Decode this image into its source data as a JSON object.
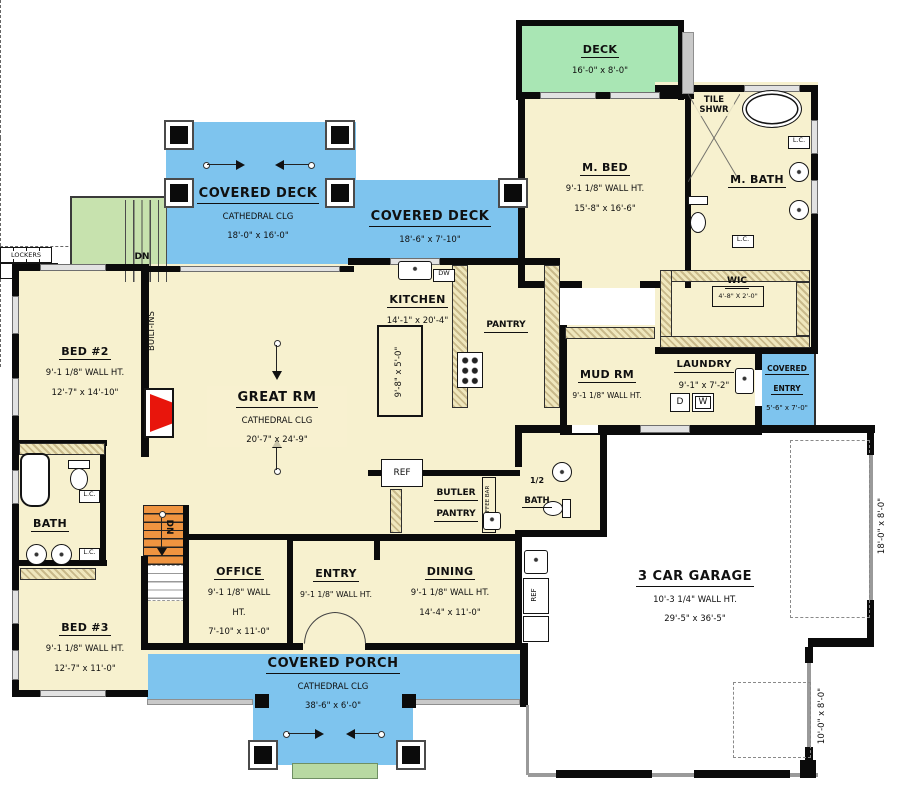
{
  "title": "First Floor Plan",
  "colors": {
    "deck_blue": "#7ec4ee",
    "deck_green": "#a9e6b4",
    "stair_green": "#c7e2ae",
    "step_green": "#b8d9a2",
    "floor_cream": "#f7f1cf",
    "stair_orange": "#ef9440",
    "fireplace_red": "#e8150c",
    "wall_black": "#0b0b0b"
  },
  "rooms": {
    "deck": {
      "name": "DECK",
      "dims": "16'-0\" x 8'-0\""
    },
    "covered_deck_main": {
      "name": "COVERED DECK",
      "clg": "CATHEDRAL CLG",
      "dims": "18'-0\" x 16'-0\""
    },
    "covered_deck_side": {
      "name": "COVERED DECK",
      "dims": "18'-6\" x 7'-10\""
    },
    "m_bed": {
      "name": "M. BED",
      "wall_ht": "9'-1 1/8\" WALL HT.",
      "dims": "15'-8\" x 16'-6\""
    },
    "tile_shwr": {
      "line1": "TILE",
      "line2": "SHWR"
    },
    "m_bath": {
      "name": "M. BATH"
    },
    "wic": {
      "name": "WIC",
      "dims": "4'-8\" X 2'-0\""
    },
    "kitchen": {
      "name": "KITCHEN",
      "dims": "14'-1\" x 20'-4\"",
      "island_dims": "9'-8\" x 5'-0\""
    },
    "pantry": {
      "name": "PANTRY"
    },
    "great_rm": {
      "name": "GREAT RM",
      "clg": "CATHEDRAL CLG",
      "dims": "20'-7\" x 24'-9\""
    },
    "bed2": {
      "name": "BED #2",
      "wall_ht": "9'-1 1/8\" WALL HT.",
      "dims": "12'-7\" x 14'-10\""
    },
    "mud_rm": {
      "name": "MUD RM",
      "wall_ht": "9'-1 1/8\" WALL HT."
    },
    "laundry": {
      "name": "LAUNDRY",
      "dims": "9'-1\" x 7'-2\""
    },
    "covered_entry": {
      "line1": "COVERED",
      "line2": "ENTRY",
      "dims": "5'-6\" x 7'-0\""
    },
    "bath": {
      "name": "BATH"
    },
    "bed3": {
      "name": "BED #3",
      "wall_ht": "9'-1 1/8\" WALL HT.",
      "dims": "12'-7\" x 11'-0\""
    },
    "office": {
      "name": "OFFICE",
      "wall_ht": "9'-1 1/8\" WALL HT.",
      "dims": "7'-10\" x 11'-0\""
    },
    "entry": {
      "name": "ENTRY",
      "wall_ht": "9'-1 1/8\" WALL HT."
    },
    "dining": {
      "name": "DINING",
      "wall_ht": "9'-1 1/8\" WALL HT.",
      "dims": "14'-4\" x 11'-0\""
    },
    "butler_pantry": {
      "line1": "BUTLER",
      "line2": "PANTRY"
    },
    "half_bath": {
      "line1": "1/2",
      "line2": "BATH"
    },
    "garage": {
      "name": "3 CAR GARAGE",
      "wall_ht": "10'-3 1/4\" WALL HT.",
      "dims": "29'-5\" x 36'-5\""
    },
    "covered_porch": {
      "name": "COVERED PORCH",
      "clg": "CATHEDRAL CLG",
      "dims": "38'-6\" x 6'-0\""
    }
  },
  "fixtures": {
    "dw": "DW",
    "ref": "REF",
    "coffee_bar": "COFFEE BAR",
    "built_ins": "BUILT-INS",
    "lockers": "LOCKERS",
    "washer": "W",
    "dryer": "D",
    "dn": "DN",
    "lc": "L.C."
  },
  "garage_doors": {
    "door_18": "18'-0\" x 8'-0\"",
    "door_10": "10'-0\" x 8'-0\""
  }
}
